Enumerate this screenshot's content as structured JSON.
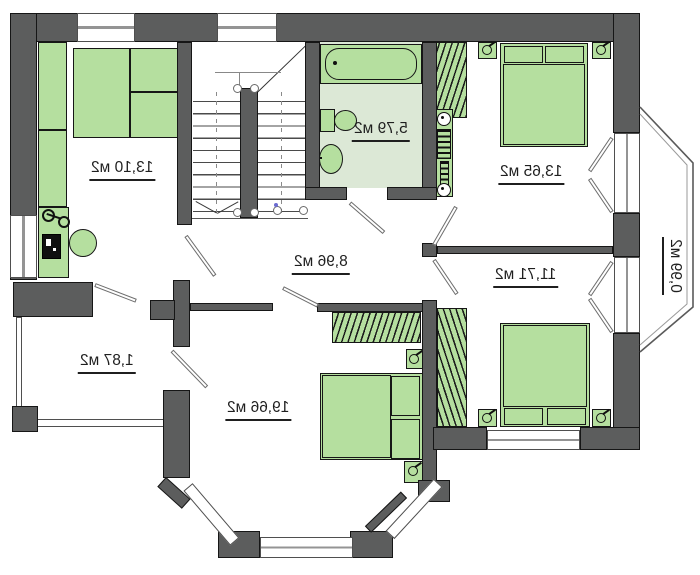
{
  "plan_labels": {
    "bedroom_top_left": "13,10 м2",
    "bathroom": "5,79 м2",
    "bedroom_top_right": "13,65 м2",
    "balcony_right": "0,99 м2",
    "bedroom_mid_right": "11,71 м2",
    "hall": "8,96 м2",
    "balcony_left": "1,87 м2",
    "bedroom_bottom": "19,66 м2"
  },
  "colors": {
    "wall": "#5c5d5d",
    "furniture_green": "#b5df9f",
    "bathroom_floor": "#dce8d6",
    "label_text": "#1f1f1f"
  },
  "units": "м2"
}
